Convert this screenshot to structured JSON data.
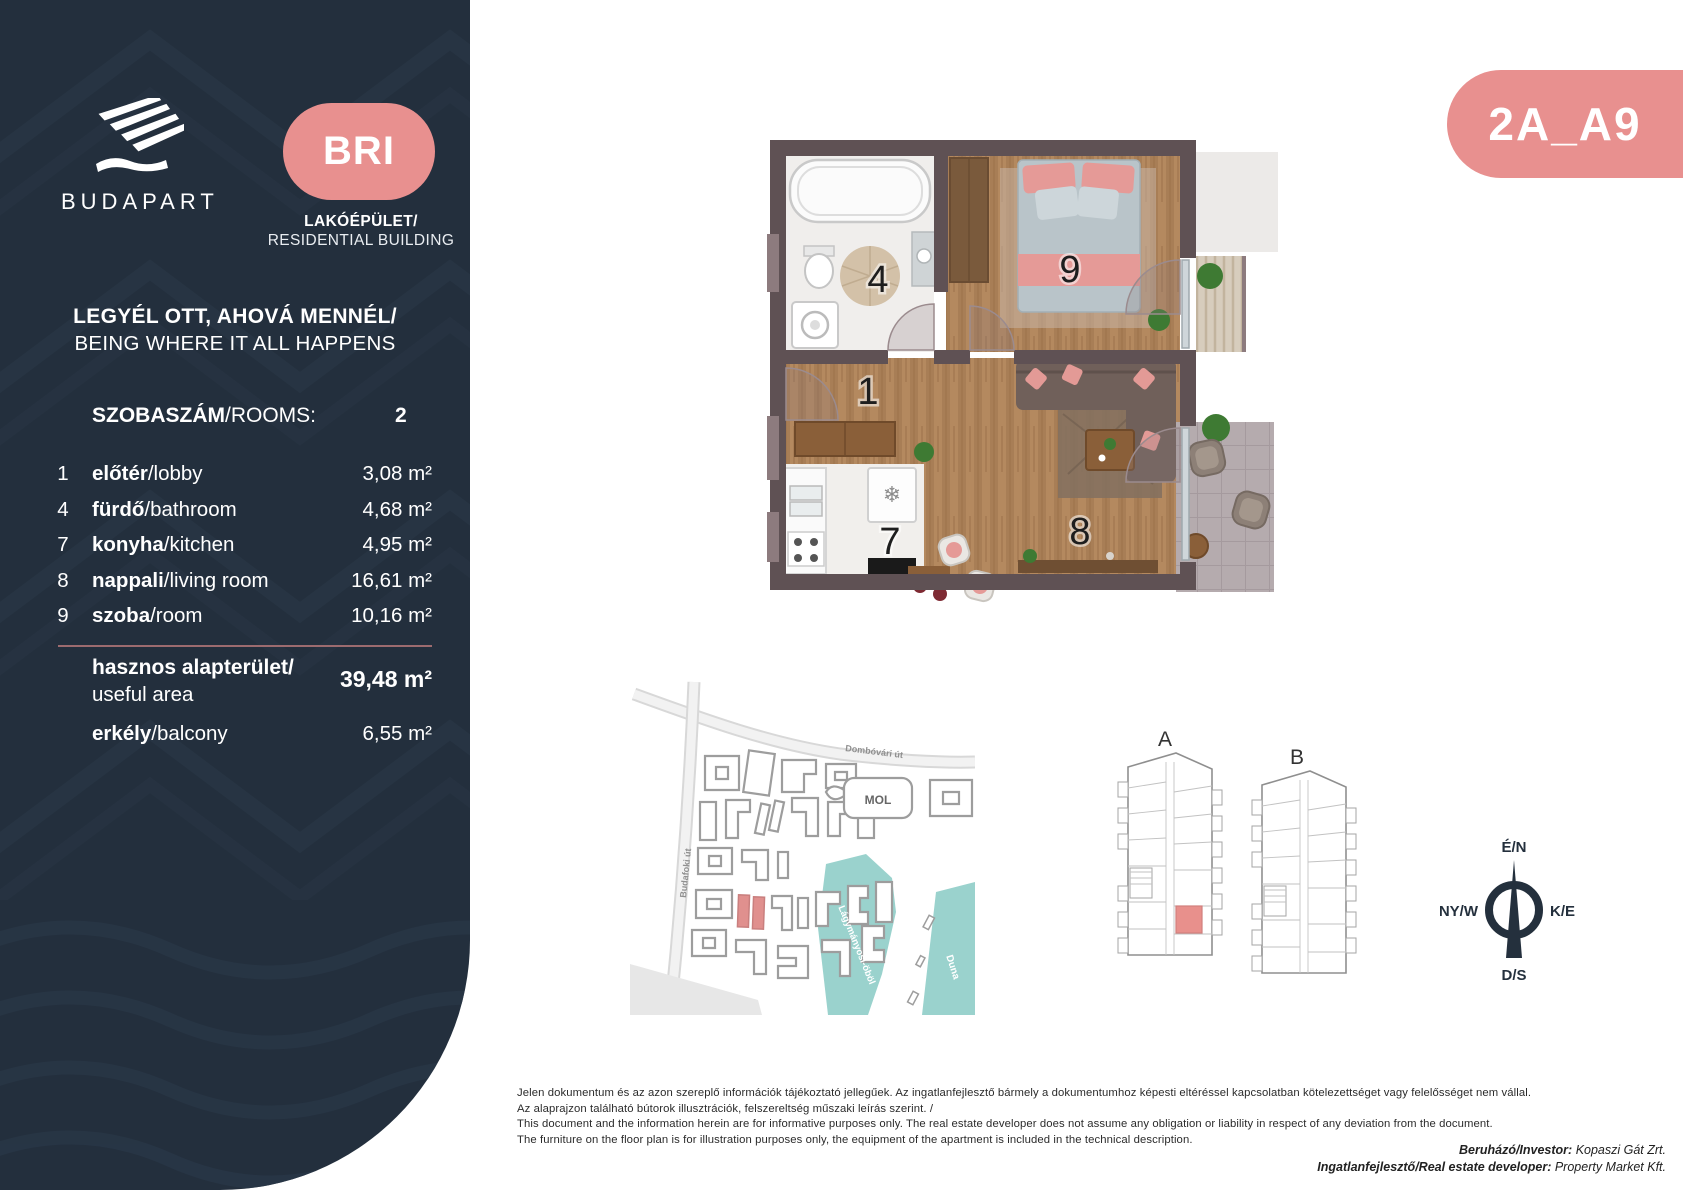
{
  "colors": {
    "panel_navy": "#232F3D",
    "accent_pink": "#E8908F",
    "water_teal": "#9AD2CD",
    "highlight_unit": "#E8908C"
  },
  "sidebar": {
    "brand": "BUDAPART",
    "badge": "BRI",
    "building_type_hu": "LAKÓÉPÜLET/",
    "building_type_en": "RESIDENTIAL BUILDING",
    "tagline_hu": "LEGYÉL OTT, AHOVÁ MENNÉL/",
    "tagline_en": "BEING WHERE IT ALL HAPPENS",
    "rooms_label_hu": "SZOBASZÁM",
    "rooms_label_en": "/ROOMS:",
    "rooms_value": "2",
    "rows": [
      {
        "num": "1",
        "hu": "előtér",
        "en": "/lobby",
        "area": "3,08 m²"
      },
      {
        "num": "4",
        "hu": "fürdő",
        "en": "/bathroom",
        "area": "4,68 m²"
      },
      {
        "num": "7",
        "hu": "konyha",
        "en": "/kitchen",
        "area": "4,95 m²"
      },
      {
        "num": "8",
        "hu": "nappali",
        "en": "/living room",
        "area": "16,61 m²"
      },
      {
        "num": "9",
        "hu": "szoba",
        "en": "/room",
        "area": "10,16 m²"
      }
    ],
    "total": {
      "hu": "hasznos alapterület/",
      "en": "useful area",
      "value": "39,48 m²"
    },
    "balcony": {
      "hu": "erkély",
      "en": "/balcony",
      "value": "6,55 m²"
    }
  },
  "unit_code": "2A_A9",
  "floorplan": {
    "numbers": {
      "lobby": "1",
      "bathroom": "4",
      "kitchen": "7",
      "living": "8",
      "room": "9"
    },
    "fridge_icon": "❄"
  },
  "map": {
    "street_top": "Dombóvári út",
    "street_left": "Budafoki út",
    "mol": "MOL",
    "bay": "Lágymányosi-öböl",
    "river": "Duna"
  },
  "buildings": {
    "a": "A",
    "b": "B"
  },
  "compass": {
    "north": "É/N",
    "west": "NY/W",
    "east": "K/E",
    "south": "D/S"
  },
  "disclaimer": {
    "l1": "Jelen dokumentum és az azon szereplő információk tájékoztató jellegűek. Az ingatlanfejlesztő bármely a dokumentumhoz képesti eltéréssel kapcsolatban kötelezettséget vagy felelősséget nem vállal.",
    "l2": "Az alaprajzon található bútorok illusztrációk, felszereltség műszaki leírás szerint. /",
    "l3": "This document and the information herein are for informative purposes only. The real estate developer does not assume any obligation or liability in respect of any deviation from the document.",
    "l4": "The furniture on the floor plan is for illustration purposes only, the equipment of the apartment is included in the technical description."
  },
  "credits": {
    "investor_label": "Beruházó/Investor:",
    "investor_value": " Kopaszi Gát Zrt.",
    "developer_label": "Ingatlanfejlesztő/Real estate developer:",
    "developer_value": " Property Market Kft."
  }
}
